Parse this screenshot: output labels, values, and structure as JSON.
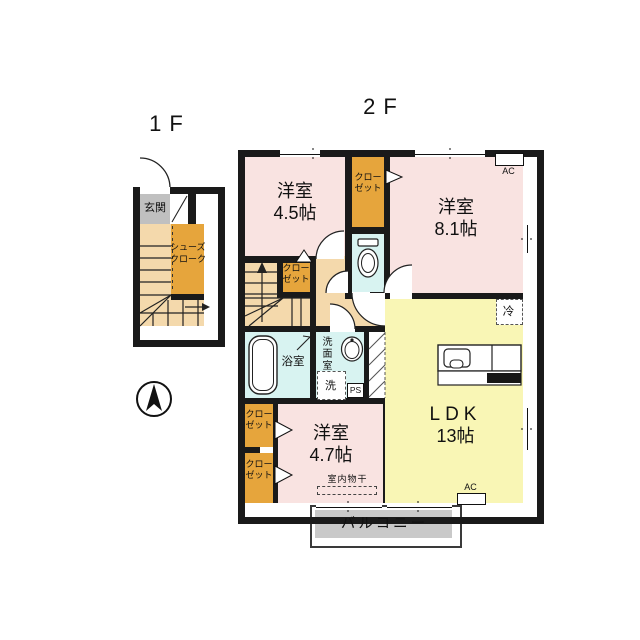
{
  "floor_labels": {
    "first": "1F",
    "second": "2F"
  },
  "labels": {
    "genkan": "玄関",
    "shoes_cloak_line1": "シューズ",
    "shoes_cloak_line2": "クローク",
    "closet_line1": "クロー",
    "closet_line2": "ゼット",
    "room45_name": "洋室",
    "room45_size": "4.5帖",
    "room81_name": "洋室",
    "room81_size": "8.1帖",
    "room47_name": "洋室",
    "room47_size": "4.7帖",
    "ldk_name": "LDK",
    "ldk_size": "13帖",
    "bathroom": "浴室",
    "washroom": "洗面室",
    "washer": "洗",
    "pipe_space": "PS",
    "refrigerator": "冷",
    "air_conditioner": "AC",
    "indoor_drying": "室内物干",
    "balcony": "バルコニー"
  },
  "colors": {
    "wall": "#1a1a1a",
    "room_pink": "#f9e3e1",
    "ldk_yellow": "#f9f6b5",
    "closet_orange": "#e6a53c",
    "wet_cyan": "#d8f3f1",
    "floor_tan": "#f4d9ac",
    "genkan_gray": "#c0c0c0",
    "balcony_gray": "#c9c9c9"
  }
}
